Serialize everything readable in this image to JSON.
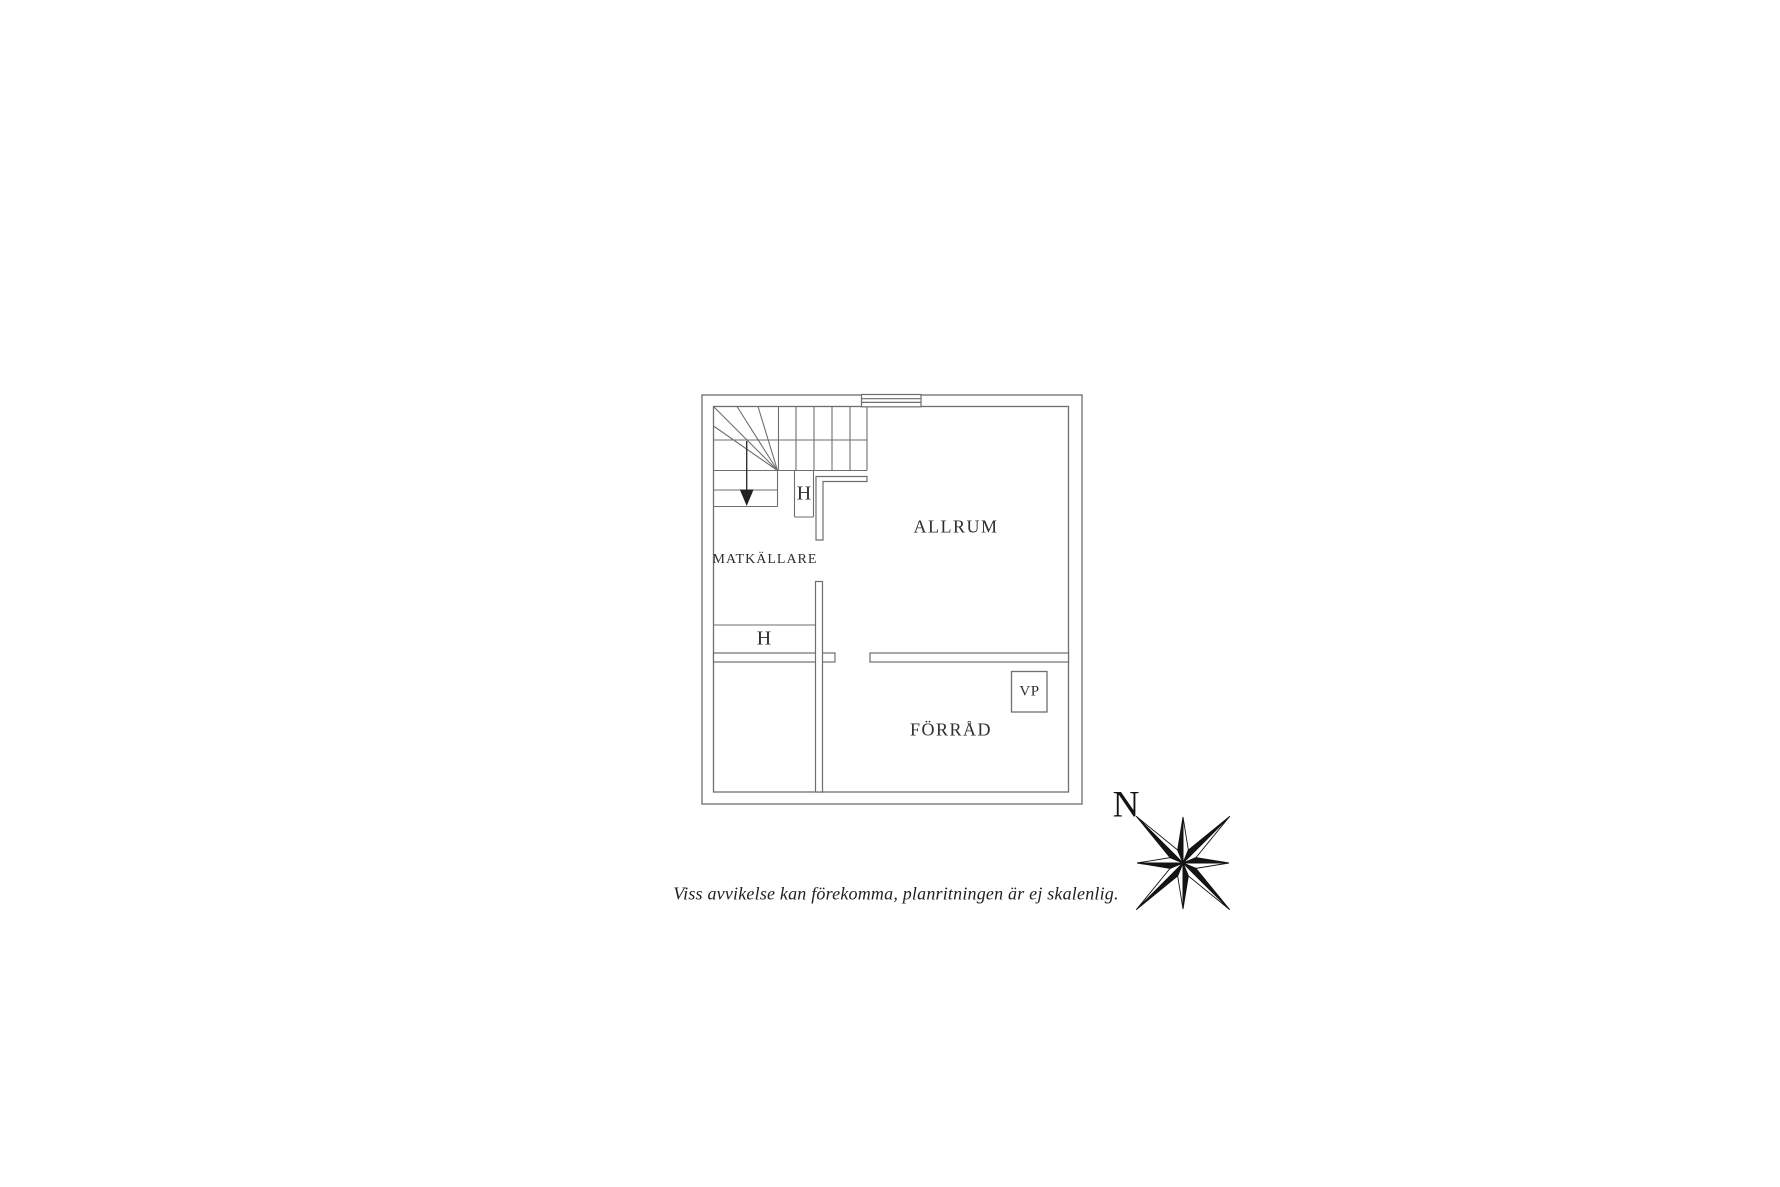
{
  "floor_plan": {
    "rooms": [
      {
        "id": "matkallare",
        "label": "MATKÄLLARE"
      },
      {
        "id": "allrum",
        "label": "ALLRUM"
      },
      {
        "id": "forrad",
        "label": "FÖRRÅD"
      }
    ],
    "markers": [
      {
        "id": "closet-upper",
        "label": "H"
      },
      {
        "id": "closet-lower",
        "label": "H"
      },
      {
        "id": "heat-pump",
        "label": "VP"
      }
    ],
    "icons": {
      "stair_arrow_icon": "down-arrow",
      "window_icon": "window-symbol",
      "compass_rose_icon": "eight-point-star"
    }
  },
  "compass": {
    "north_label": "N"
  },
  "footer": {
    "disclaimer": "Viss avvikelse kan förekomma, planritningen är ej skalenlig."
  },
  "colors": {
    "wall_line": "#6e6e6e",
    "text": "#2e2e2e",
    "compass": "#141414",
    "background": "#ffffff"
  }
}
